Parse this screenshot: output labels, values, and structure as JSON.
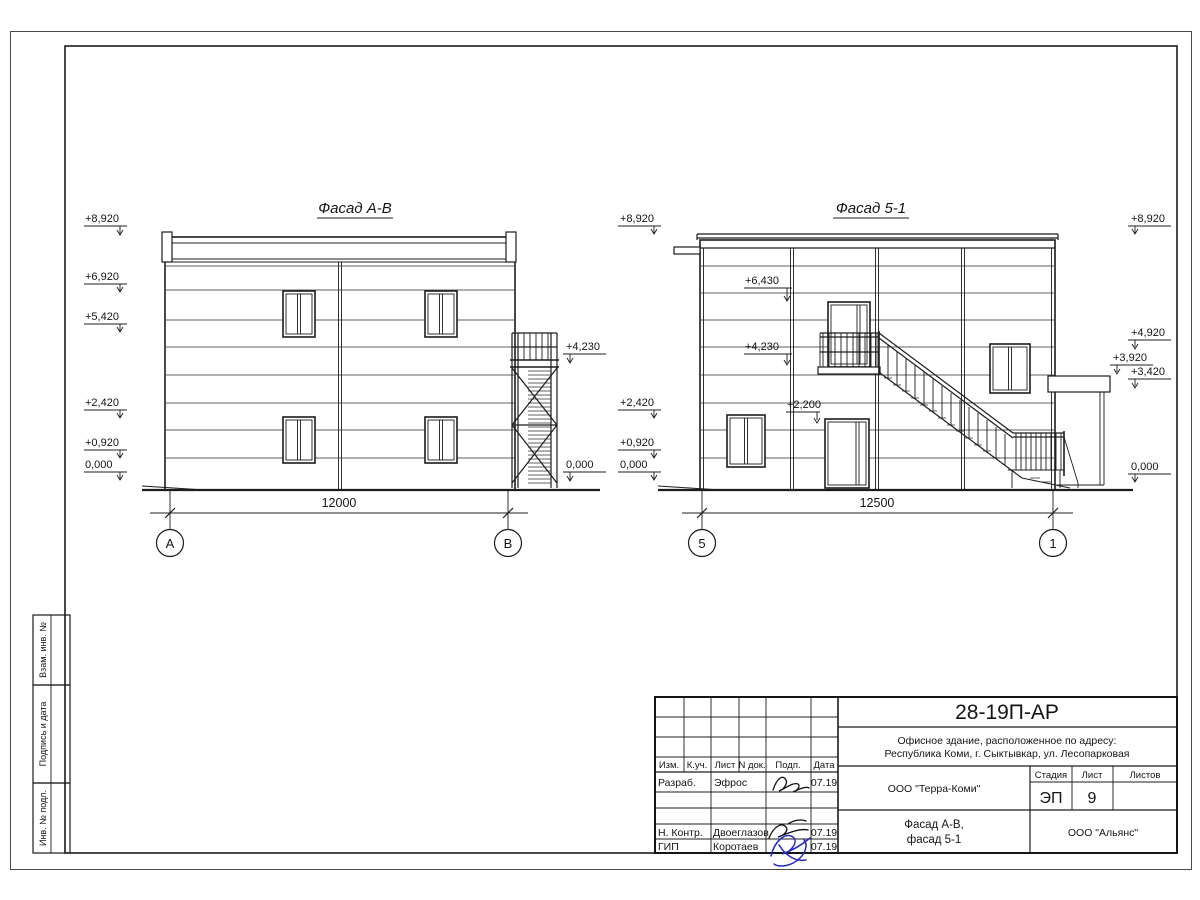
{
  "side_stamp": [
    "Взам. инв. №",
    "Подпись и дата",
    "Инв. № подл."
  ],
  "facade_ab": {
    "title": "Фасад А-В",
    "dim": "12000",
    "axis_a": "А",
    "axis_b": "В",
    "marks_left": [
      "+8,920",
      "+6,920",
      "+5,420",
      "+2,420",
      "+0,920",
      "0,000"
    ],
    "marks_right": [
      "+4,230",
      "0,000"
    ]
  },
  "facade_51": {
    "title": "Фасад 5-1",
    "dim": "12500",
    "axis_a": "5",
    "axis_b": "1",
    "marks_left": [
      "+8,920",
      "+2,420",
      "+0,920",
      "0,000"
    ],
    "marks_inner": [
      "+6,430",
      "+4,230",
      "+2,200"
    ],
    "marks_right": [
      "+8,920",
      "+4,920",
      "+3,920",
      "+3,420",
      "0,000"
    ]
  },
  "titleblock": {
    "code": "28-19П-АР",
    "address1": "Офисное здание, расположенное по адресу:",
    "address2": "Республика Коми, г. Сыктывкар, ул. Лесопарковая",
    "org": "ООО \"Терра-Коми\"",
    "firm": "ООО \"Альянс\"",
    "doc1": "Фасад А-В,",
    "doc2": "фасад 5-1",
    "stage_label": "Стадия",
    "sheet_label": "Лист",
    "sheets_label": "Листов",
    "stage": "ЭП",
    "sheet_no": "9",
    "cols": [
      "Изм.",
      "К.уч.",
      "Лист",
      "N док.",
      "Подп.",
      "Дата"
    ],
    "roles": [
      {
        "role": "Разраб.",
        "name": "Эфрос",
        "date": "07.19"
      },
      {
        "role": "Н. Контр.",
        "name": "Двоеглазов",
        "date": "07.19"
      },
      {
        "role": "ГИП",
        "name": "Коротаев",
        "date": "07.19"
      }
    ]
  }
}
